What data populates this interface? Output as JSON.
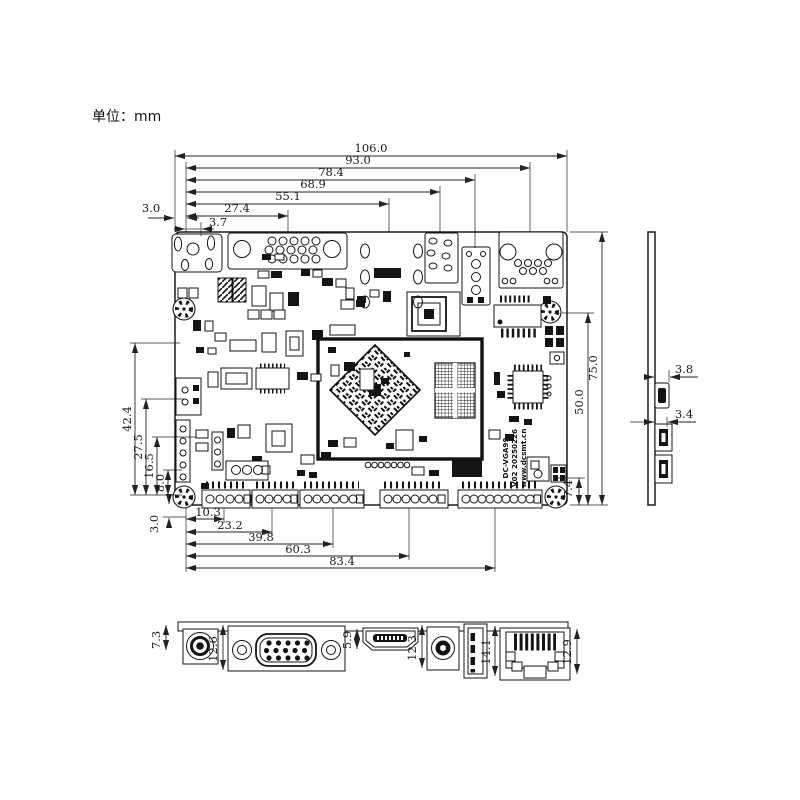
{
  "unit_label": "单位：mm",
  "silkscreen": {
    "line1": "DC-VGA99",
    "line2": "V02 20250226",
    "line3": "www.dcsmt.cn"
  },
  "dims": {
    "top": [
      "106.0",
      "93.0",
      "78.4",
      "68.9",
      "55.1",
      "27.4",
      "3.7"
    ],
    "top_left": "3.0",
    "left": [
      "42.4",
      "27.5",
      "16.5",
      "8.0"
    ],
    "bottom_left": "3.0",
    "right": [
      "75.0",
      "50.0",
      "7.4"
    ],
    "bottom": [
      "10.3",
      "23.2",
      "39.8",
      "60.3",
      "83.4"
    ],
    "side": [
      "3.8",
      "3.4"
    ],
    "front": [
      "7.3",
      "12.6",
      "5.9",
      "12.3",
      "14.1",
      "12.9"
    ]
  }
}
